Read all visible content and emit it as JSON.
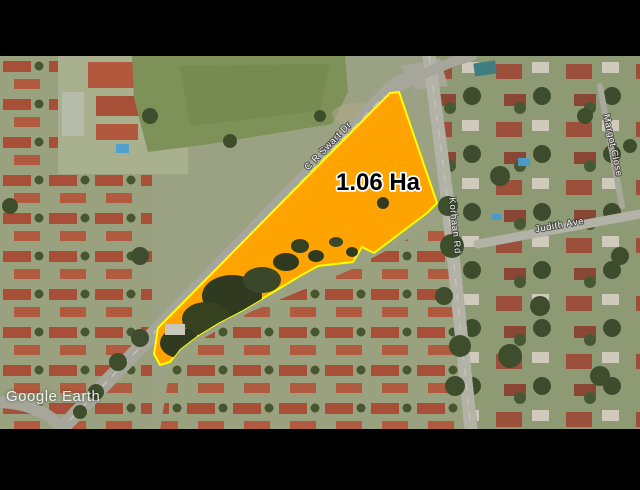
{
  "app": {
    "watermark": "Google Earth"
  },
  "map": {
    "description": "Aerial satellite view of a suburban neighbourhood with a highlighted land parcel, letterboxed top and bottom",
    "letterbox_color": "#000000",
    "parcel": {
      "label": "1.06 Ha",
      "fill_color": "#FFA301",
      "outline_color": "#FFFF00",
      "label_color": "#000000",
      "label_halo_color": "#FFFFFF"
    },
    "roads": [
      {
        "id": "cr-swart-dr",
        "label": "C R Swart Dr"
      },
      {
        "id": "korhaan-rd",
        "label": "Korhaan Rd"
      },
      {
        "id": "judith-ave",
        "label": "Judith Ave"
      },
      {
        "id": "margot-close",
        "label": "Margot Close"
      }
    ]
  }
}
